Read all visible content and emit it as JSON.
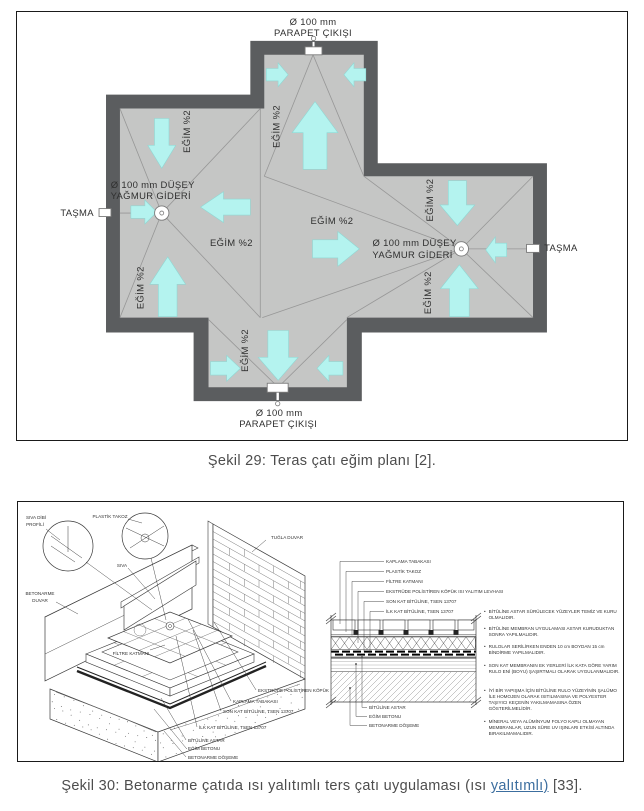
{
  "figure1": {
    "caption": "Şekil 29: Teras çatı eğim planı [2].",
    "labels": {
      "parapet_outlet": [
        "Ø 100 mm",
        "PARAPET ÇIKIŞI"
      ],
      "rain_drain": [
        "Ø 100 mm DÜŞEY",
        "YAĞMUR GİDERİ"
      ],
      "overflow": "TAŞMA",
      "slope": "EĞİM %2"
    },
    "colors": {
      "wall": "#5b5d5f",
      "roof": "#c5c6c5",
      "arrow": "#b4f3ef",
      "arrow_edge": "#8fd8d4",
      "ridge_line": "#979797",
      "text": "#2f2f2f",
      "fixture_stroke": "#7a7a7a"
    }
  },
  "figure2": {
    "caption": {
      "prefix": "Şekil 30: Betonarme çatıda ısı yalıtımlı ters çatı uygulaması (ısı ",
      "link": "yalıtımlı)",
      "suffix": " [33]."
    },
    "iso_labels": {
      "siva_dibi": [
        "SIVA DİBİ",
        "PROFİLİ"
      ],
      "plastik_takoz": "PLASTİK TAKOZ",
      "siva": "SIVA",
      "tugla_duvar": "TUĞLA DUVAR",
      "betonarme_duvar": [
        "BETONARME",
        "DUVAR"
      ],
      "filtre_katmani": "FİLTRE KATMANI",
      "ekstrude": "EKSTRÜDE POLİSTİREN KÖPÜK",
      "kaplama": "KAPLAMA TABAKASI",
      "son_kat": "SON KAT BİTÜLİNE, TSEN 13707",
      "ilk_kat": "İLK KAT BİTÜLİNE, TSEN 13707",
      "astar": "BİTÜLİNE ASTAR",
      "egim_betonu": "EĞİM BETONU",
      "doseme": "BETONARME DÖŞEME"
    },
    "section_labels_top": [
      "KAPLAMA TABAKASI",
      "PLASTİK TAKOZ",
      "FİLTRE KATMANI",
      "EKSTRÜDE POLİSTİREN KÖPÜK ISI YALITIM LEVHASI",
      "SON KAT BİTÜLİNE, TSEN 13707",
      "İLK KAT BİTÜLİNE, TSEN 13707"
    ],
    "section_labels_bottom": [
      "BİTÜLİNE ASTAR",
      "EĞİM BETONU",
      "BETONARME DÖŞEME"
    ],
    "notes": [
      "BİTÜLİNE ASTAR SÜRÜLECEK YÜZEYLER TEMİZ VE KURU OLMALIDIR.",
      "BİTÜLİNE MEMBRAN UYGULAMASI ASTAR KURUDUKTAN SONRA YAPILMALIDIR.",
      "RULOLAR SERİLİRKEN ENDEN 10 cm BOYDAN 15 cm BİNDİRME YAPILMALIDIR.",
      "SON KAT MEMBRANIN EK YERLERİ İLK KATA GÖRE YARIM RULO ENİ (BOYU) ŞAŞIRTMALI OLARAK UYGULANMALIDIR.",
      "İYİ BİR YAPIŞMA İÇİN BİTÜLİNE RULO YÜZEYİNİN ŞALÜMO İLE HOMOJEN OLARAK ISITILMASINA VE POLYESTER TAŞIYICI KEÇENİN YAKILMAMASINA ÖZEN GÖSTERİLMELİDİR.",
      "MİNERAL VEYA ALÜMİNYUM FOLYO KAPLI OLMAYAN MEMBRANLAR, UZUN SÜRE UV IŞINLARI ETKİSİ ALTINDA BIRAKILMAMALIDIR."
    ]
  }
}
